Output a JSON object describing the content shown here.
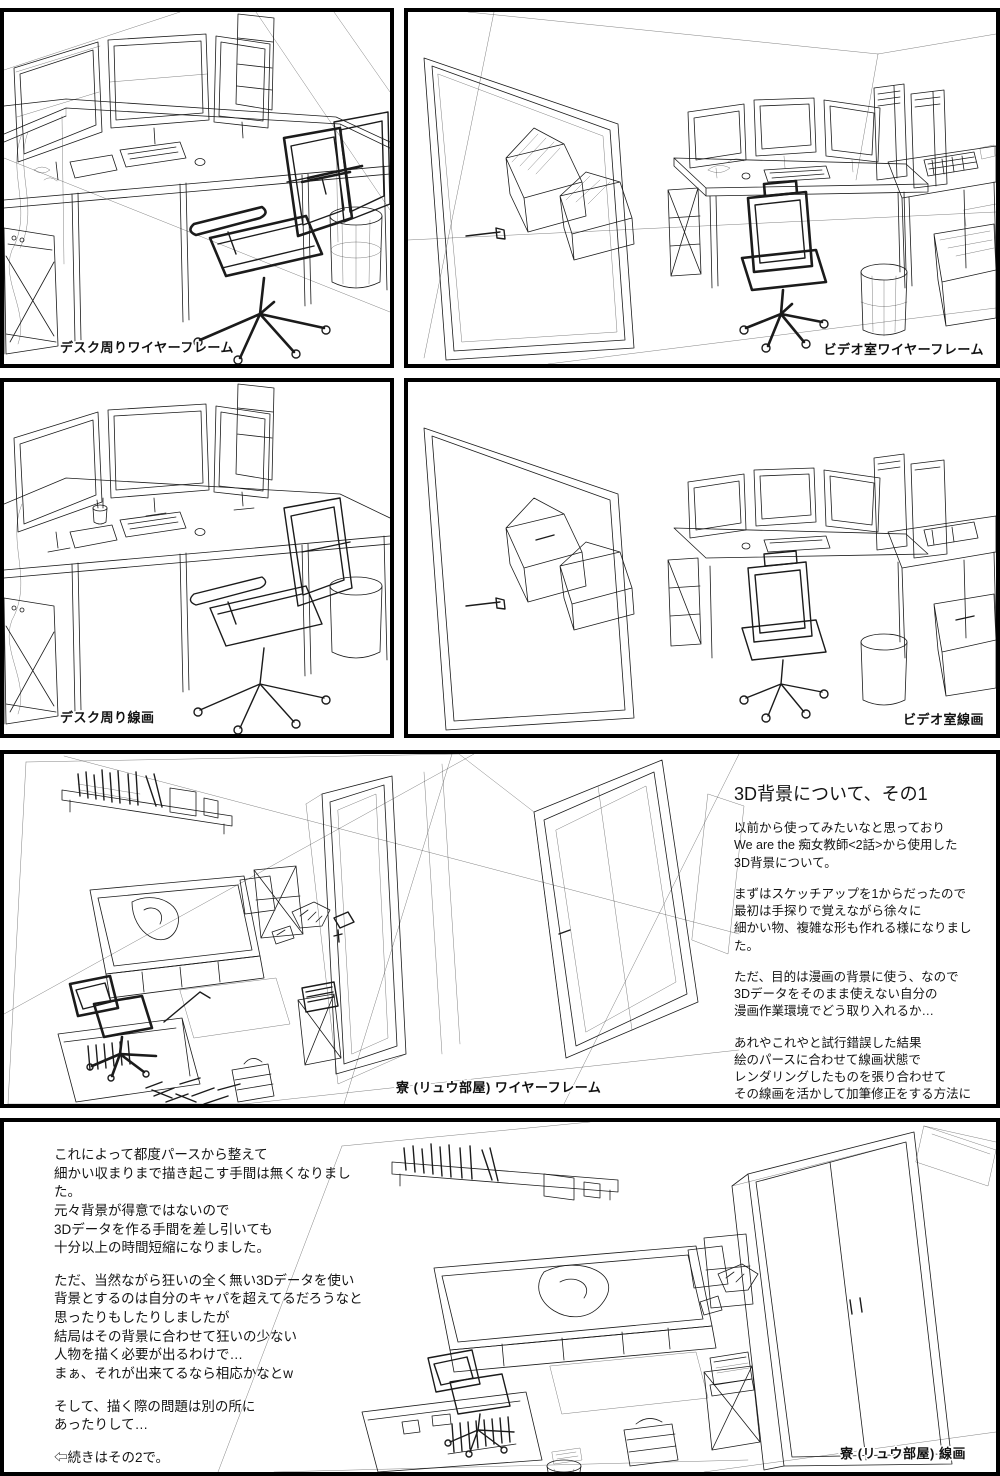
{
  "page": {
    "background": "#ffffff",
    "panel_border_color": "#000000",
    "ink_color": "#1b1b1b"
  },
  "panels": {
    "desk_wireframe": {
      "caption": "デスク周りワイヤーフレーム"
    },
    "video_wireframe": {
      "caption": "ビデオ室ワイヤーフレーム"
    },
    "desk_lineart": {
      "caption": "デスク周り線画"
    },
    "video_lineart": {
      "caption": "ビデオ室線画"
    },
    "dorm_wireframe": {
      "caption": "寮 (リュウ部屋) ワイヤーフレーム"
    },
    "dorm_lineart": {
      "caption": "寮 (リュウ部屋) 線画"
    }
  },
  "article_part1": {
    "title": "3D背景について、その1",
    "paragraphs": [
      "以前から使ってみたいなと思っており\nWe are the 痴女教師<2話>から使用した\n3D背景について。",
      "まずはスケッチアップを1からだったので\n最初は手探りで覚えながら徐々に\n細かい物、複雑な形も作れる様になりました。",
      "ただ、目的は漫画の背景に使う、なので\n3Dデータをそのまま使えない自分の\n漫画作業環境でどう取り入れるか…",
      "あれやこれやと試行錯誤した結果\n絵のパースに合わせて線画状態で\nレンダリングしたものを張り合わせて\nその線画を活かして加筆修正をする方法に\n落ち着きました。"
    ]
  },
  "article_part2": {
    "paragraphs": [
      "これによって都度パースから整えて\n細かい収まりまで描き起こす手間は無くなりました。\n元々背景が得意ではないので\n3Dデータを作る手間を差し引いても\n十分以上の時間短縮になりました。",
      "ただ、当然ながら狂いの全く無い3Dデータを使い\n背景とするのは自分のキャパを超えてるだろうなと\n思ったりもしたりしましたが\n結局はその背景に合わせて狂いの少ない\n人物を描く必要が出るわけで…\nまぁ、それが出来てるなら相応かなとw",
      "そして、描く際の問題は別の所に\nあったりして…",
      "⇦続きはその2で。"
    ]
  }
}
